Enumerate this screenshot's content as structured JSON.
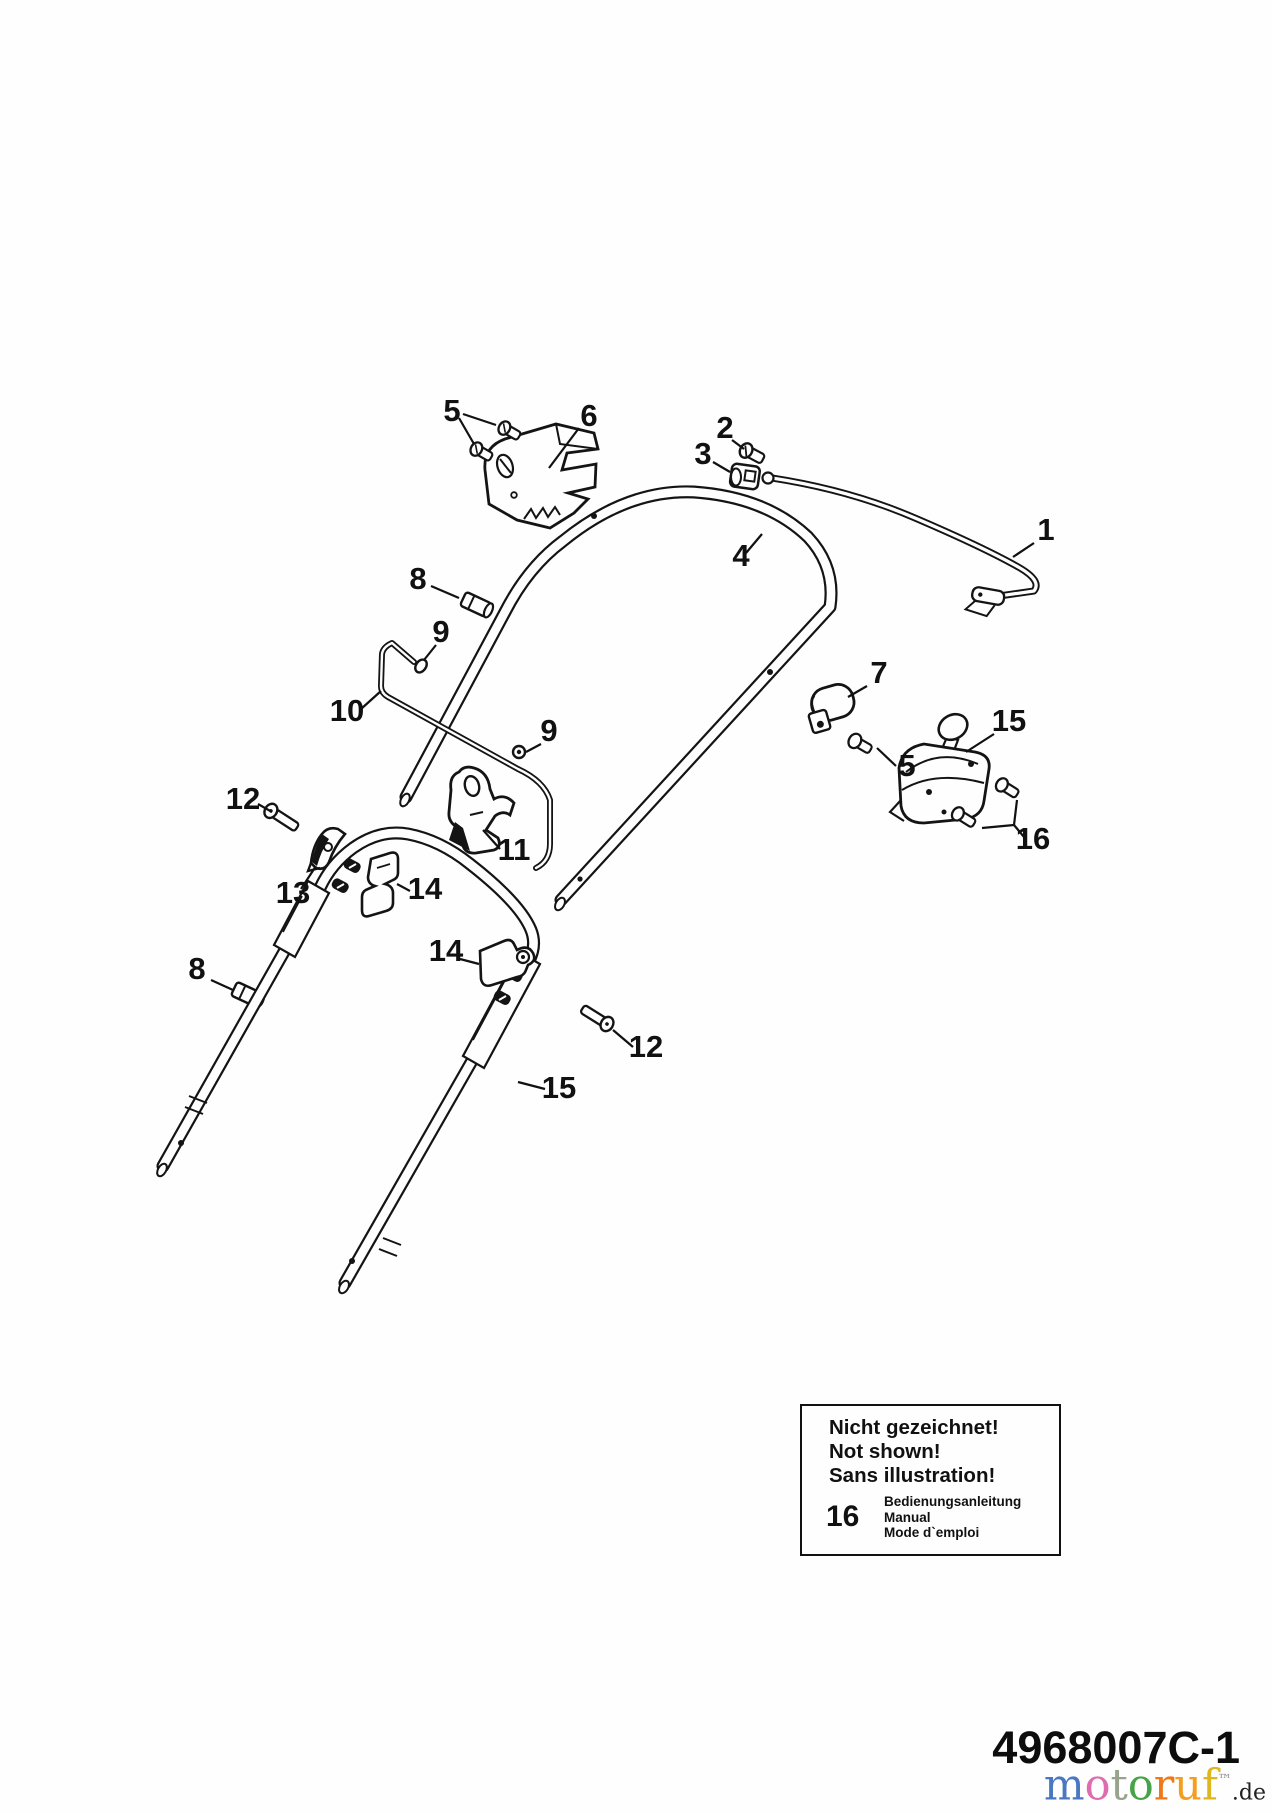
{
  "page": {
    "background": "#fdfefd"
  },
  "diagram": {
    "description": "Exploded parts diagram of a lawn mower handlebar assembly",
    "part_labels": [
      {
        "text": "5",
        "x": 452,
        "y": 421,
        "leaders": [
          [
            463,
            414,
            496,
            425
          ],
          [
            459,
            418,
            474,
            444
          ]
        ]
      },
      {
        "text": "6",
        "x": 589,
        "y": 426,
        "leaders": [
          [
            579,
            428,
            549,
            468
          ]
        ]
      },
      {
        "text": "2",
        "x": 725,
        "y": 438,
        "leaders": [
          [
            732,
            440,
            744,
            449
          ]
        ]
      },
      {
        "text": "3",
        "x": 703,
        "y": 464,
        "leaders": [
          [
            713,
            462,
            730,
            472
          ]
        ]
      },
      {
        "text": "4",
        "x": 741,
        "y": 566,
        "leaders": [
          [
            746,
            553,
            762,
            534
          ]
        ]
      },
      {
        "text": "1",
        "x": 1046,
        "y": 540,
        "leaders": [
          [
            1034,
            543,
            1013,
            557
          ]
        ]
      },
      {
        "text": "8",
        "x": 418,
        "y": 589,
        "leaders": [
          [
            431,
            586,
            459,
            598
          ]
        ]
      },
      {
        "text": "9",
        "x": 441,
        "y": 642,
        "leaders": [
          [
            436,
            645,
            424,
            660
          ]
        ]
      },
      {
        "text": "10",
        "x": 347,
        "y": 721,
        "leaders": [
          [
            361,
            709,
            381,
            691
          ]
        ]
      },
      {
        "text": "9",
        "x": 549,
        "y": 741,
        "leaders": [
          [
            541,
            744,
            526,
            752
          ]
        ]
      },
      {
        "text": "11",
        "x": 514,
        "y": 860,
        "leaders": [
          [
            500,
            849,
            483,
            830
          ]
        ]
      },
      {
        "text": "12",
        "x": 243,
        "y": 809,
        "leaders": [
          [
            258,
            804,
            272,
            812
          ]
        ]
      },
      {
        "text": "13",
        "x": 293,
        "y": 903,
        "leaders": [
          [
            301,
            889,
            316,
            866
          ]
        ]
      },
      {
        "text": "14",
        "x": 425,
        "y": 899,
        "leaders": [
          [
            410,
            891,
            397,
            884
          ]
        ]
      },
      {
        "text": "14",
        "x": 446,
        "y": 961,
        "leaders": [
          [
            460,
            959,
            479,
            964
          ]
        ]
      },
      {
        "text": "8",
        "x": 197,
        "y": 979,
        "leaders": [
          [
            211,
            980,
            233,
            990
          ]
        ]
      },
      {
        "text": "12",
        "x": 646,
        "y": 1057,
        "leaders": [
          [
            633,
            1047,
            613,
            1030
          ]
        ]
      },
      {
        "text": "15",
        "x": 559,
        "y": 1098,
        "leaders": [
          [
            545,
            1089,
            518,
            1082
          ]
        ]
      },
      {
        "text": "7",
        "x": 879,
        "y": 683,
        "leaders": [
          [
            867,
            686,
            848,
            697
          ]
        ]
      },
      {
        "text": "15",
        "x": 1009,
        "y": 731,
        "leaders": [
          [
            994,
            734,
            966,
            752
          ]
        ]
      },
      {
        "text": "5",
        "x": 907,
        "y": 776,
        "leaders": [
          [
            896,
            766,
            877,
            748
          ]
        ]
      },
      {
        "text": "16",
        "x": 1033,
        "y": 849,
        "leaders": [
          [
            1017,
            800,
            1014,
            825
          ],
          [
            982,
            828,
            1014,
            825
          ],
          [
            1014,
            825,
            1024,
            837
          ]
        ]
      }
    ]
  },
  "info_box": {
    "title_line1": "Nicht gezeichnet!",
    "title_line2": "Not shown!",
    "title_line3": "Sans illustration!",
    "item_number": "16",
    "item_line1": "Bedienungsanleitung",
    "item_line2": "Manual",
    "item_line3": "Mode d`emploi"
  },
  "footer": {
    "part_code": "4968007C-1",
    "logo_letters": [
      {
        "ch": "m",
        "color": "#4a77c2"
      },
      {
        "ch": "o",
        "color": "#e06cb0"
      },
      {
        "ch": "t",
        "color": "#97a38c"
      },
      {
        "ch": "o",
        "color": "#46a348"
      },
      {
        "ch": "r",
        "color": "#f07818"
      },
      {
        "ch": "u",
        "color": "#f59d1e"
      },
      {
        "ch": "f",
        "color": "#dfb61e"
      },
      {
        "ch": "™",
        "color": "#8a8a8a"
      }
    ],
    "logo_suffix": ".de"
  }
}
